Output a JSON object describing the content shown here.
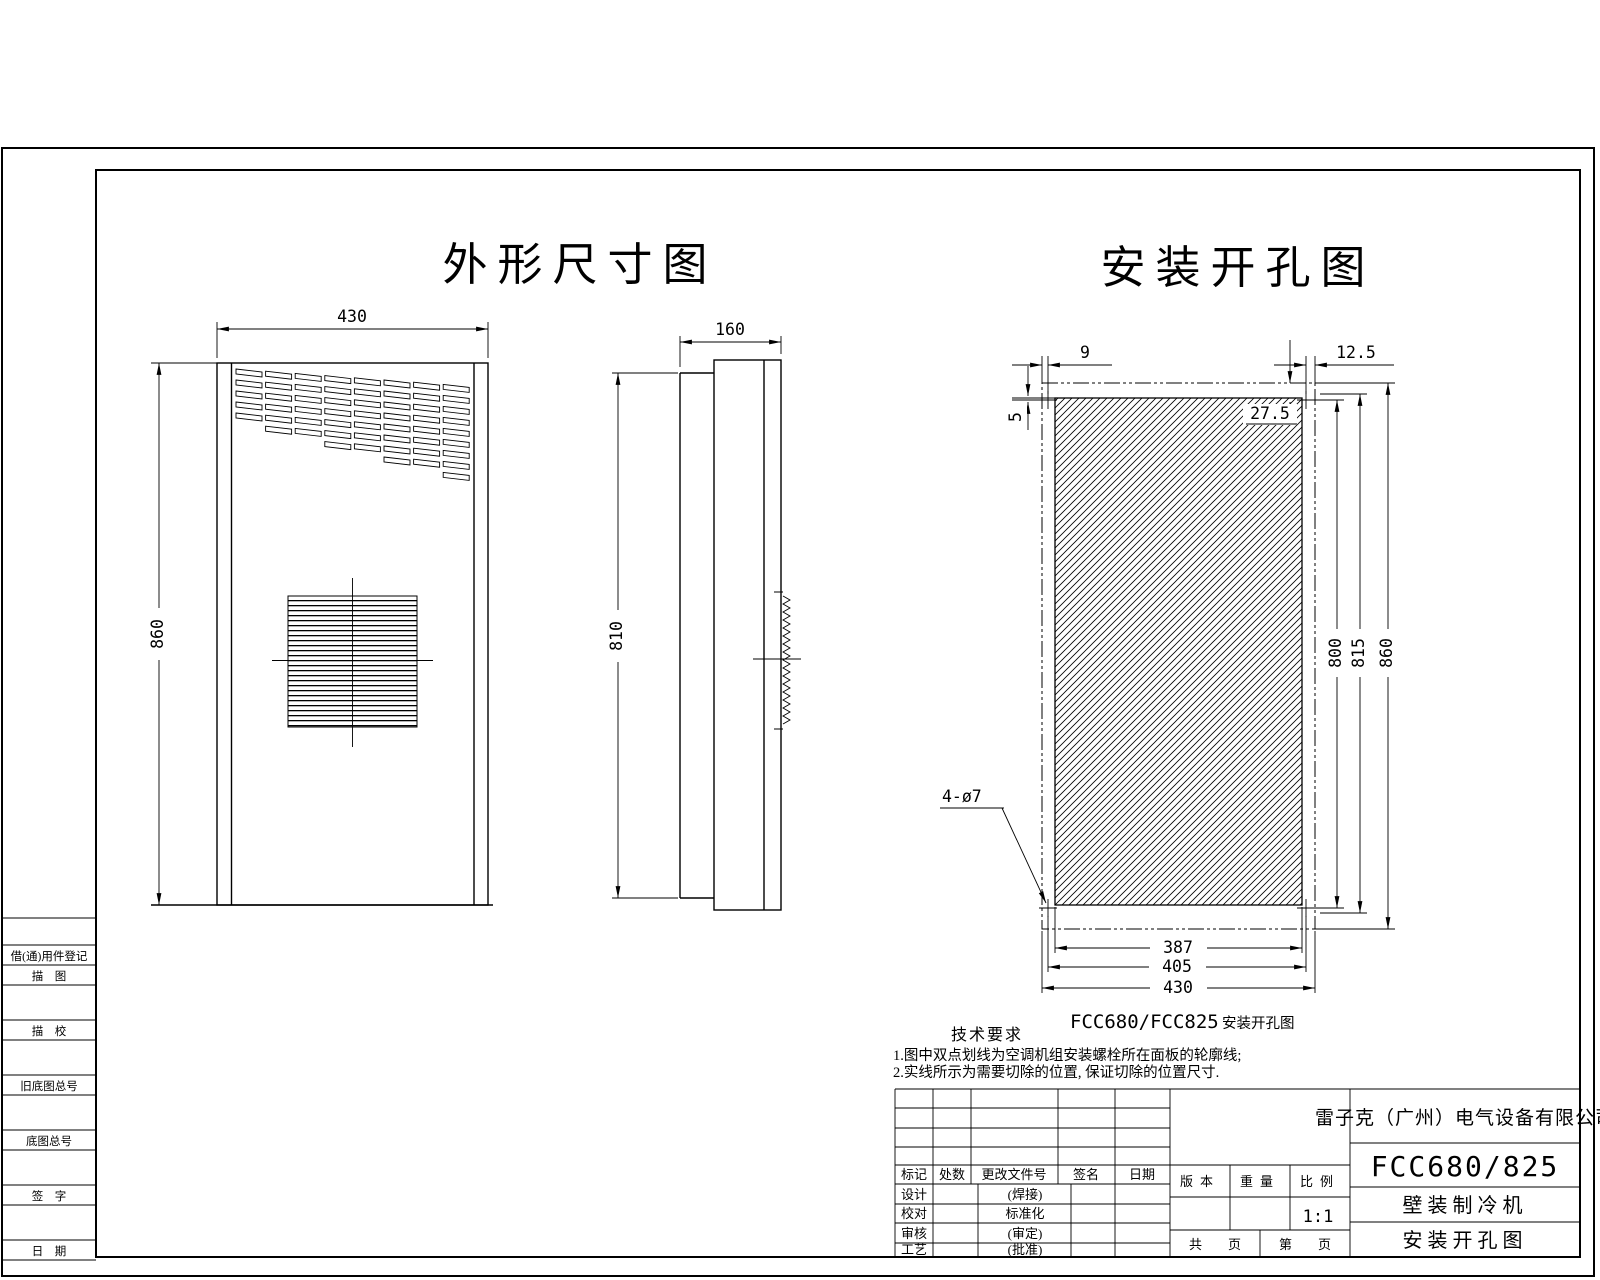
{
  "titles": {
    "outline_view": "外形尺寸图",
    "install_view": "安装开孔图"
  },
  "front_view": {
    "width": "430",
    "height": "860"
  },
  "side_view": {
    "depth": "160",
    "height": "810"
  },
  "install_view": {
    "edge_to_hole_left": "9",
    "hole_to_edge_right": "12.5",
    "top_to_hole": "27.5",
    "hole_to_cut": "5",
    "hole_spacing_v": "800",
    "cut_height": "815",
    "panel_height": "860",
    "cut_width": "387",
    "hole_spacing_h": "405",
    "panel_width": "430",
    "hole_callout": "4-ø7",
    "caption_model": "FCC680/FCC825",
    "caption_text": "安装开孔图"
  },
  "tech_notes": {
    "title": "技术要求",
    "line1": "1.图中双点划线为空调机组安装螺栓所在面板的轮廓线;",
    "line2": "2.实线所示为需要切除的位置, 保证切除的位置尺寸."
  },
  "margin_column": {
    "labels": [
      "借(通)用件登记",
      "描　图",
      "描　校",
      "旧底图总号",
      "底图总号",
      "签　字",
      "日　期"
    ]
  },
  "title_block": {
    "company": "雷子克（广州）电气设备有限公司",
    "model": "FCC680/825",
    "product_name": "壁装制冷机",
    "drawing_name": "安装开孔图",
    "rev_headers": [
      "标记",
      "处数",
      "更改文件号",
      "签名",
      "日期"
    ],
    "roles": [
      "设计",
      "校对",
      "审核",
      "工艺"
    ],
    "approvals": [
      "(焊接)",
      "标准化",
      "(审定)",
      "(批准)"
    ],
    "meta_headers": [
      "版本",
      "重量",
      "比例"
    ],
    "scale": "1:1",
    "total_pages": "共　　页",
    "page_no": "第　　页"
  }
}
